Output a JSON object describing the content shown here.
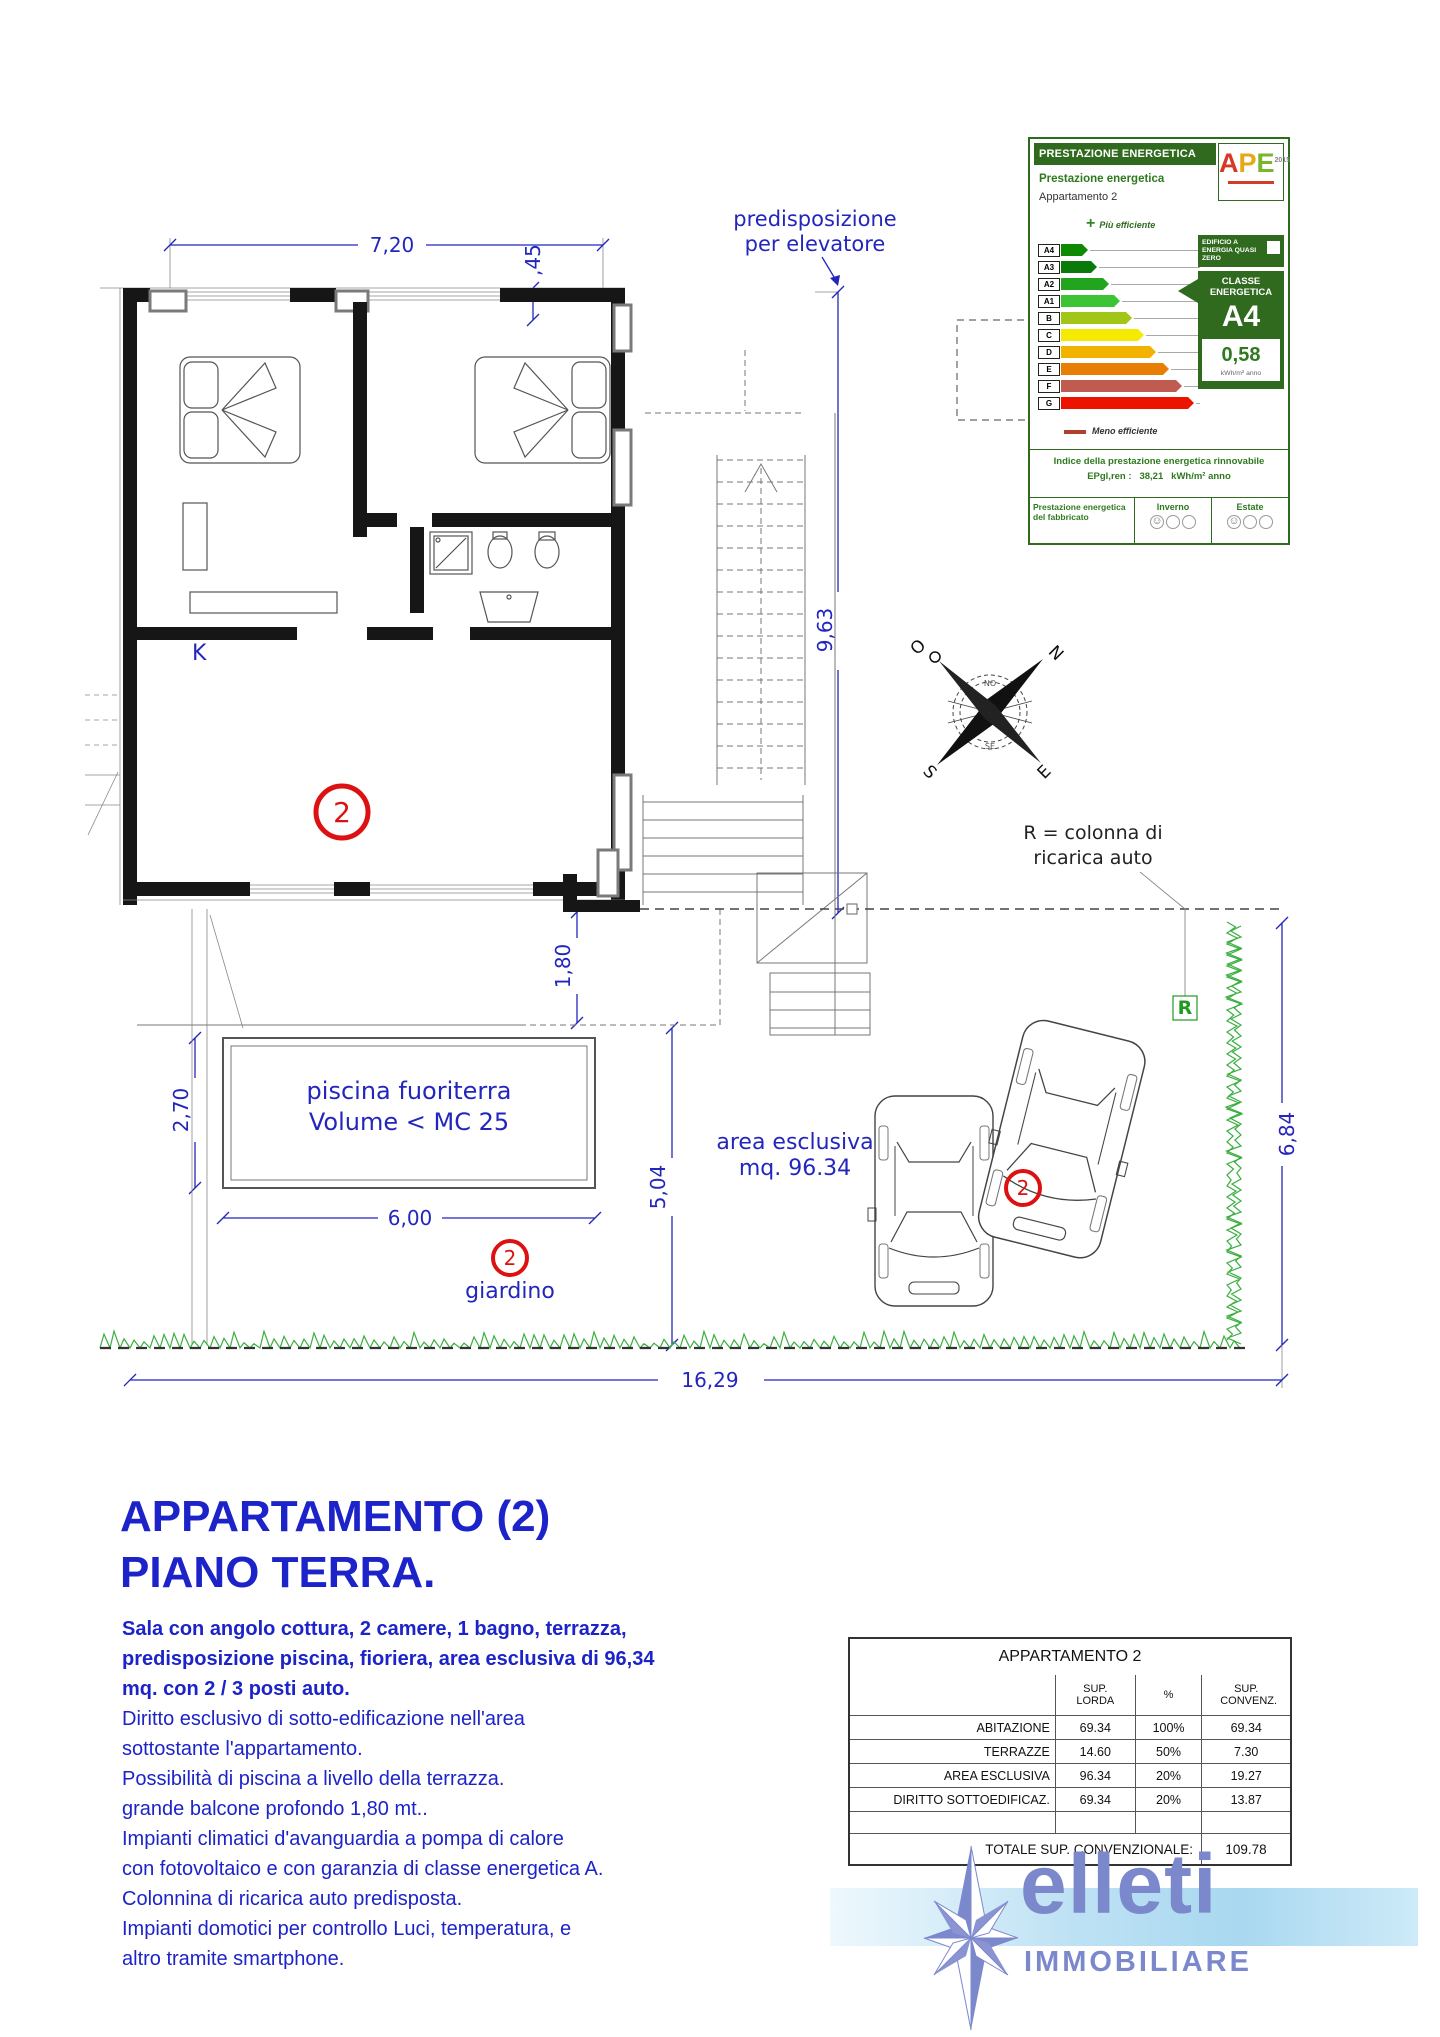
{
  "certificate": {
    "header": "PRESTAZIONE ENERGETICA",
    "logo": {
      "a": "A",
      "p": "P",
      "e": "E",
      "year": "2015"
    },
    "section_title": "Prestazione energetica",
    "subject": "Appartamento 2",
    "plus": "+",
    "more_efficient": "Più efficiente",
    "less_efficient": "Meno efficiente",
    "classes": [
      {
        "label": "A4",
        "color": "#0d8a00",
        "width": 27
      },
      {
        "label": "A3",
        "color": "#0a7a0a",
        "width": 36
      },
      {
        "label": "A2",
        "color": "#23a41e",
        "width": 48
      },
      {
        "label": "A1",
        "color": "#3cc435",
        "width": 59
      },
      {
        "label": "B",
        "color": "#a2c617",
        "width": 71
      },
      {
        "label": "C",
        "color": "#f5ea02",
        "width": 83
      },
      {
        "label": "D",
        "color": "#f2b200",
        "width": 95
      },
      {
        "label": "E",
        "color": "#e87e04",
        "width": 108
      },
      {
        "label": "F",
        "color": "#bf5b51",
        "width": 121
      },
      {
        "label": "G",
        "color": "#ec1300",
        "width": 133
      }
    ],
    "nzeb": "EDIFICIO A ENERGIA QUASI ZERO",
    "class_label_1": "CLASSE",
    "class_label_2": "ENERGETICA",
    "class_value": "A4",
    "ep_value": "0,58",
    "ep_unit": "kWh/m² anno",
    "renewable_title": "Indice della prestazione energetica rinnovabile",
    "renewable_label": "EPgl,ren :",
    "renewable_value": "38,21",
    "renewable_unit": "kWh/m² anno",
    "fabric_label": "Prestazione energetica del fabbricato",
    "winter_label": "Inverno",
    "summer_label": "Estate"
  },
  "plan": {
    "dim_top": "7,20",
    "dim_wall": ",45",
    "dim_right": "9,63",
    "dim_balcony": "1,80",
    "dim_pool_h": "2,70",
    "dim_pool_w": "6,00",
    "dim_mid": "5,04",
    "dim_hedge": "6,84",
    "dim_bottom": "16,29",
    "elevator_note_1": "predisposizione",
    "elevator_note_2": "per elevatore",
    "kitchen_label": "K",
    "unit_number": "2",
    "pool_label_1": "piscina fuoriterra",
    "pool_label_2": "Volume < MC 25",
    "area_label_1": "area esclusiva",
    "area_label_2": "mq. 96.34",
    "garden_label": "giardino",
    "charger_note_1": "R = colonna di",
    "charger_note_2": "ricarica auto",
    "charger_mark": "R",
    "compass": {
      "n": "N",
      "o": "O",
      "s": "S",
      "e": "E",
      "no": "NO",
      "se": "SE"
    }
  },
  "info": {
    "title_line_1": "APPARTAMENTO (2)",
    "title_line_2": "PIANO TERRA.",
    "lines": [
      "Sala con angolo cottura, 2 camere, 1 bagno, terrazza,",
      "predisposizione piscina, fioriera, area esclusiva di 96,34",
      "mq. con 2 / 3 posti auto.",
      "Diritto esclusivo di sotto-edificazione nell'area",
      "sottostante l'appartamento.",
      "Possibilità di piscina a livello della terrazza.",
      "grande balcone profondo 1,80 mt..",
      "Impianti climatici d'avanguardia a pompa di calore",
      "con fotovoltaico e con garanzia di classe energetica A.",
      "Colonnina di ricarica auto predisposta.",
      "Impianti domotici per controllo Luci, temperatura, e",
      "altro tramite smartphone."
    ]
  },
  "table": {
    "title": "APPARTAMENTO 2",
    "headers": {
      "c2": "SUP. LORDA",
      "c3": "%",
      "c4": "SUP. CONVENZ."
    },
    "rows": [
      {
        "label": "ABITAZIONE",
        "lorda": "69.34",
        "pct": "100%",
        "conv": "69.34"
      },
      {
        "label": "TERRAZZE",
        "lorda": "14.60",
        "pct": "50%",
        "conv": "7.30"
      },
      {
        "label": "AREA ESCLUSIVA",
        "lorda": "96.34",
        "pct": "20%",
        "conv": "19.27"
      },
      {
        "label": "DIRITTO SOTTOEDIFICAZ.",
        "lorda": "69.34",
        "pct": "20%",
        "conv": "13.87"
      }
    ],
    "total_label": "TOTALE SUP. CONVENZIONALE:",
    "total_value": "109.78"
  },
  "logo": {
    "name": "elleti",
    "subtitle": "IMMOBILIARE"
  }
}
